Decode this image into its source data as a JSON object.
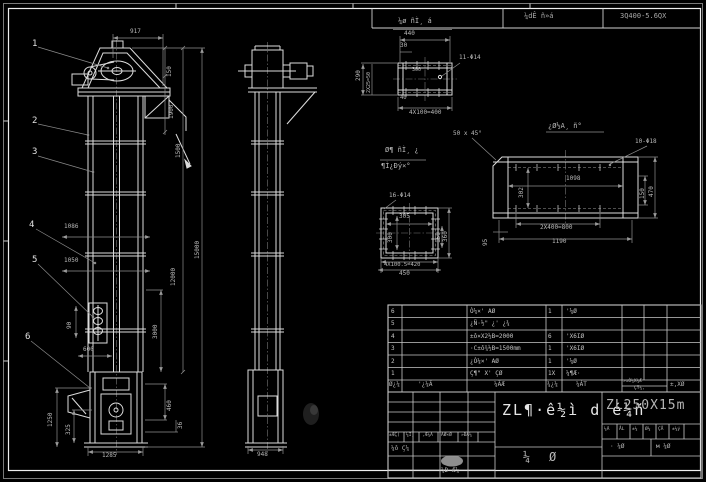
{
  "colors": {
    "background": "#000000",
    "linework": "#dcdcdc",
    "dimension_lines": "#8f8f8f",
    "table_lines": "#cccccc",
    "text": "#b9b9b9"
  },
  "header": {
    "doc_type": "¼dÊ ñ»á",
    "model_code": "3Q400-5.6QX"
  },
  "bom": {
    "header": {
      "seq": "Ø¿¼",
      "code": "'¿¼Ã",
      "name": "¼ÃÆ",
      "qty": "¾¿¼",
      "material": "¼ÁT",
      "weight_top": "»±Ò¼X¼Æ",
      "weight_bottom": "ÇŸ¼,",
      "note": "±,XØ"
    },
    "rows": [
      {
        "seq": "6",
        "code": "",
        "name": "Ò¼×' AØ",
        "qty": "1",
        "material": "'¼Ø"
      },
      {
        "seq": "5",
        "code": "",
        "name": "¿Ñ·½\" ¿' ¿¾",
        "qty": "",
        "material": ""
      },
      {
        "seq": "4",
        "code": "",
        "name": "±ô×X2½B=2000",
        "qty": "6",
        "material": "'X6IØ"
      },
      {
        "seq": "3",
        "code": "",
        "name": "·C±ô¾½B=1500mm",
        "qty": "1",
        "material": "'X6IØ"
      },
      {
        "seq": "2",
        "code": "",
        "name": "¿Ò¼×' AØ",
        "qty": "1",
        "material": "'¼Ø"
      },
      {
        "seq": "1",
        "code": "",
        "name": "Ç¶\" X' ÇØ",
        "qty": "1X",
        "material": "¼¶Æ·"
      }
    ]
  },
  "annotations": [
    {
      "n": "header-doc-type",
      "t": "¼dÊ ñ»á",
      "x": 524,
      "y": 13,
      "s": 7,
      "c": "#a8a8a8"
    },
    {
      "n": "header-model-code",
      "t": "3Q400-5.6QX",
      "x": 620,
      "y": 13,
      "s": 7,
      "c": "#a8a8a8"
    },
    {
      "n": "detail-a-view-title",
      "t": "¼ø ñÌ¸ á",
      "x": 398,
      "y": 18,
      "s": 7
    },
    {
      "n": "beam-detail-view-title",
      "t": "¿Ø½A¸ ñ°",
      "x": 548,
      "y": 123,
      "s": 7
    },
    {
      "n": "plate-detail-view-title-upper",
      "t": "Ø¶ ñÌ¸ ¿",
      "x": 385,
      "y": 147,
      "s": 7
    },
    {
      "n": "plate-detail-view-title-lower",
      "t": "¶Ì¿Ðý×°",
      "x": 381,
      "y": 163,
      "s": 7
    },
    {
      "n": "balloon-1",
      "t": "1",
      "x": 32,
      "y": 40,
      "s": 9,
      "c": "#e2e2e2"
    },
    {
      "n": "balloon-2",
      "t": "2",
      "x": 32,
      "y": 117,
      "s": 9,
      "c": "#e2e2e2"
    },
    {
      "n": "balloon-3",
      "t": "3",
      "x": 32,
      "y": 148,
      "s": 9,
      "c": "#e2e2e2"
    },
    {
      "n": "balloon-4",
      "t": "4",
      "x": 29,
      "y": 221,
      "s": 9,
      "c": "#e2e2e2"
    },
    {
      "n": "balloon-5",
      "t": "5",
      "x": 32,
      "y": 256,
      "s": 9,
      "c": "#e2e2e2"
    },
    {
      "n": "balloon-6",
      "t": "6",
      "x": 25,
      "y": 333,
      "s": 9,
      "c": "#e2e2e2"
    },
    {
      "n": "dim-head-width",
      "t": "917",
      "x": 130,
      "y": 29
    },
    {
      "n": "dim-roof-height",
      "t": "150",
      "x": 167,
      "y": 77,
      "r": 1
    },
    {
      "n": "dim-head-height",
      "t": "1900",
      "x": 169,
      "y": 119,
      "r": 1
    },
    {
      "n": "dim-upper-section",
      "t": "1500",
      "x": 176,
      "y": 158,
      "r": 1
    },
    {
      "n": "dim-casing-1086",
      "t": "1086",
      "x": 64,
      "y": 224
    },
    {
      "n": "dim-casing-1050",
      "t": "1050",
      "x": 64,
      "y": 258
    },
    {
      "n": "dim-total-height",
      "t": "15000",
      "x": 195,
      "y": 259,
      "r": 1
    },
    {
      "n": "dim-mid-height",
      "t": "12000",
      "x": 171,
      "y": 286,
      "r": 1
    },
    {
      "n": "dim-lower-section",
      "t": "3000",
      "x": 153,
      "y": 339,
      "r": 1
    },
    {
      "n": "dim-door-90",
      "t": "90",
      "x": 67,
      "y": 329,
      "r": 1
    },
    {
      "n": "dim-hopper-600",
      "t": "600",
      "x": 83,
      "y": 347
    },
    {
      "n": "dim-boot-1250",
      "t": "1250",
      "x": 48,
      "y": 427,
      "r": 1
    },
    {
      "n": "dim-boot-325",
      "t": "325",
      "x": 66,
      "y": 435,
      "r": 1
    },
    {
      "n": "dim-boot-460",
      "t": "460",
      "x": 167,
      "y": 411,
      "r": 1
    },
    {
      "n": "dim-boot-36",
      "t": "36",
      "x": 178,
      "y": 429,
      "r": 1
    },
    {
      "n": "dim-boot-width",
      "t": "1285",
      "x": 102,
      "y": 453
    },
    {
      "n": "dim-side-width",
      "t": "948",
      "x": 257,
      "y": 452
    },
    {
      "n": "dim-a-440",
      "t": "440",
      "x": 404,
      "y": 31
    },
    {
      "n": "dim-a-30",
      "t": "30",
      "x": 400,
      "y": 43
    },
    {
      "n": "dim-a-290",
      "t": "290",
      "x": 356,
      "y": 81,
      "r": 1
    },
    {
      "n": "dim-a-25",
      "t": "2X25=50",
      "x": 367,
      "y": 93,
      "r": 1,
      "s": 5
    },
    {
      "n": "dim-a-300",
      "t": "300",
      "x": 412,
      "y": 68,
      "s": 5
    },
    {
      "n": "dim-a-40",
      "t": "40",
      "x": 400,
      "y": 96,
      "s": 5.5
    },
    {
      "n": "dim-a-pitch",
      "t": "4X100=400",
      "x": 409,
      "y": 110
    },
    {
      "n": "note-a-holes",
      "t": "11-Φ14",
      "x": 459,
      "y": 55
    },
    {
      "n": "note-chamfer",
      "t": "50 x 45°",
      "x": 453,
      "y": 131
    },
    {
      "n": "note-beam-holes",
      "t": "10-Φ18",
      "x": 635,
      "y": 139
    },
    {
      "n": "dim-beam-1098",
      "t": "1098",
      "x": 566,
      "y": 176
    },
    {
      "n": "dim-beam-302",
      "t": "302",
      "x": 519,
      "y": 198,
      "r": 1
    },
    {
      "n": "dim-beam-150",
      "t": "150",
      "x": 640,
      "y": 199,
      "r": 1
    },
    {
      "n": "dim-beam-470",
      "t": "470",
      "x": 649,
      "y": 197,
      "r": 1
    },
    {
      "n": "dim-beam-pitch",
      "t": "2X400=800",
      "x": 540,
      "y": 225
    },
    {
      "n": "dim-beam-1190",
      "t": "1190",
      "x": 552,
      "y": 239
    },
    {
      "n": "dim-beam-95",
      "t": "95",
      "x": 483,
      "y": 246,
      "r": 1
    },
    {
      "n": "note-plate-holes",
      "t": "16-Φ14",
      "x": 389,
      "y": 193
    },
    {
      "n": "dim-plate-305",
      "t": "305",
      "x": 399,
      "y": 214
    },
    {
      "n": "dim-plate-300",
      "t": "300",
      "x": 388,
      "y": 243,
      "r": 1
    },
    {
      "n": "dim-plate-150",
      "t": "150",
      "x": 436,
      "y": 243,
      "r": 1
    },
    {
      "n": "dim-plate-360",
      "t": "360",
      "x": 443,
      "y": 242,
      "r": 1
    },
    {
      "n": "dim-plate-pitch",
      "t": "4X100.5=420",
      "x": 384,
      "y": 263,
      "s": 5.5
    },
    {
      "n": "dim-plate-450",
      "t": "450",
      "x": 399,
      "y": 271
    },
    {
      "n": "main-title",
      "t": "ZL¶·ê½ì d é¼ñ",
      "x": 502,
      "y": 403,
      "s": 15,
      "c": "#e6e6e6",
      "ls": 2
    },
    {
      "n": "drawing-number",
      "t": "ZL250X15m",
      "x": 606,
      "y": 399,
      "s": 13,
      "c": "#b4b4b4",
      "ls": 1
    },
    {
      "n": "title-block-glyph-1",
      "t": "¼",
      "x": 523,
      "y": 451,
      "s": 12
    },
    {
      "n": "title-block-glyph-2",
      "t": "Ø",
      "x": 549,
      "y": 451,
      "s": 12
    },
    {
      "n": "scale-cell-1",
      "t": "¼Ã",
      "x": 604,
      "y": 428,
      "s": 4.5
    },
    {
      "n": "scale-cell-2",
      "t": "ÅL",
      "x": 619,
      "y": 428,
      "s": 4.5
    },
    {
      "n": "scale-cell-3",
      "t": "±¼",
      "x": 632,
      "y": 428,
      "s": 4.5
    },
    {
      "n": "scale-cell-4",
      "t": "Ø¼",
      "x": 645,
      "y": 428,
      "s": 4.5
    },
    {
      "n": "scale-cell-5",
      "t": "ÇÅ",
      "x": 658,
      "y": 428,
      "s": 4.5
    },
    {
      "n": "scale-cell-6",
      "t": "±¼ý",
      "x": 672,
      "y": 428,
      "s": 4.5
    },
    {
      "n": "sheet-count-left",
      "t": "· ¼Ø",
      "x": 610,
      "y": 444,
      "s": 6
    },
    {
      "n": "sheet-count-right",
      "t": "м ¼Ø",
      "x": 656,
      "y": 444,
      "s": 6
    },
    {
      "n": "rev-header-1",
      "t": "±ÆÇ(",
      "x": 389,
      "y": 434,
      "s": 4.5
    },
    {
      "n": "rev-header-2",
      "t": "¼Ì¸",
      "x": 406,
      "y": 434,
      "s": 4.5
    },
    {
      "n": "rev-header-3",
      "t": ",Æ¼Ã",
      "x": 422,
      "y": 434,
      "s": 4.5
    },
    {
      "n": "rev-header-4",
      "t": "ÃØ×Ø",
      "x": 441,
      "y": 434,
      "s": 4.5
    },
    {
      "n": "rev-header-5",
      "t": "»ÐÅ¼",
      "x": 461,
      "y": 434,
      "s": 4.5
    },
    {
      "n": "sign-label-design",
      "t": "¼ô Ç¼",
      "x": 391,
      "y": 446,
      "s": 6
    },
    {
      "n": "sign-label-check",
      "t": "¼Ð Æ¼",
      "x": 441,
      "y": 468,
      "s": 6
    }
  ]
}
